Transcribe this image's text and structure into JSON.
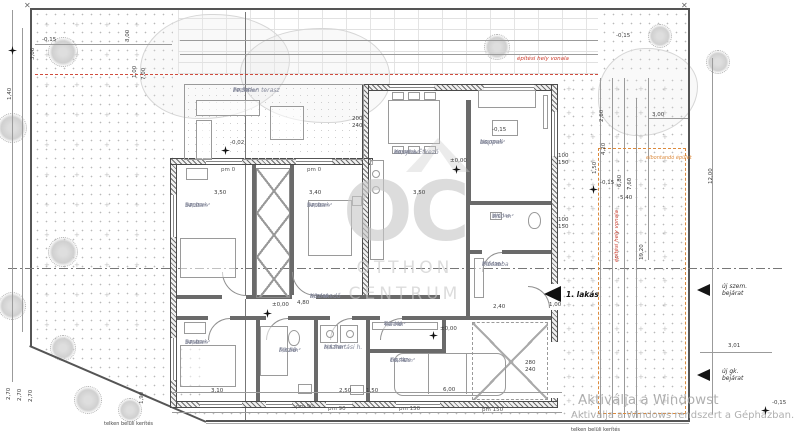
{
  "annotations": {
    "building_line_top": "építési hely vonala",
    "building_line_side": "építési hely vonala",
    "demolish": "elbontandó épület",
    "fence_left": "telken belüli kerítés",
    "fence_right": "telken belüli kerítés",
    "flat_entrance": "1. lakás",
    "entrance_ped_1": "új szem.",
    "entrance_ped_2": "bejárat",
    "entrance_veh_1": "új gk.",
    "entrance_veh_2": "bejárat"
  },
  "watermark": {
    "letters": "OC",
    "line1": "OTTHON",
    "line2": "CENTRUM"
  },
  "windows_activation": {
    "line1": "Aktiválja a Windowst",
    "line2": "Aktiválja a Windows rendszert a Gépházban."
  },
  "rooms": [
    {
      "name": "Fedetlen terasz",
      "floor": "ker. lap",
      "area": "22,50 m²",
      "x": 233,
      "y": 88,
      "w": 92
    },
    {
      "name": "Szoba",
      "floor": "lam.park.",
      "area": "14,35 m²",
      "x": 185,
      "y": 203,
      "w": 62
    },
    {
      "name": "Szoba",
      "floor": "lam.park.",
      "area": "14,76 m²",
      "x": 307,
      "y": 203,
      "w": 62
    },
    {
      "name": "Konyha-Étkező",
      "floor": "lam.park.",
      "area": "29,06 m²",
      "x": 394,
      "y": 150,
      "w": 64
    },
    {
      "name": "Nappali",
      "floor": "lam.park.",
      "area": "16,02 m²",
      "x": 480,
      "y": 140,
      "w": 60
    },
    {
      "name": "WC",
      "floor": "ker. lap",
      "area": "3,90 m²",
      "x": 492,
      "y": 214,
      "w": 46
    },
    {
      "name": "Előszoba",
      "floor": "ker. lap",
      "area": "7,26 m²",
      "x": 482,
      "y": 262,
      "w": 58
    },
    {
      "name": "Közlekedő",
      "floor": "ker. lap",
      "area": "5,76 m²",
      "x": 310,
      "y": 294,
      "w": 56
    },
    {
      "name": "Szoba",
      "floor": "lam.park.",
      "area": "14,46 m²",
      "x": 185,
      "y": 340,
      "w": 62
    },
    {
      "name": "Fürdő",
      "floor": "ker. lap",
      "area": "5,62 m²",
      "x": 279,
      "y": 348,
      "w": 40
    },
    {
      "name": "Háztartási h.",
      "floor": "ker. lap",
      "area": "5,51 m²",
      "x": 324,
      "y": 345,
      "w": 50
    },
    {
      "name": "Tároló",
      "floor": "ker. lap",
      "area": "4,27 m²",
      "x": 384,
      "y": 322,
      "w": 52
    },
    {
      "name": "Garázs",
      "floor": "ker. lap",
      "area": "16,74 m²",
      "x": 390,
      "y": 358,
      "w": 52
    }
  ],
  "dims": [
    {
      "t": "3,06",
      "x": 31,
      "y": 60,
      "v": 1
    },
    {
      "t": "3,00",
      "x": 126,
      "y": 42,
      "v": 1
    },
    {
      "t": "1,00",
      "x": 133,
      "y": 78,
      "v": 1
    },
    {
      "t": "7,00",
      "x": 142,
      "y": 80,
      "v": 1
    },
    {
      "t": "1,40",
      "x": 8,
      "y": 100,
      "v": 1
    },
    {
      "t": "-0,15",
      "x": 42,
      "y": 38,
      "v": 0
    },
    {
      "t": "-0,15",
      "x": 616,
      "y": 34,
      "v": 0
    },
    {
      "t": "-0,02",
      "x": 230,
      "y": 141,
      "v": 0
    },
    {
      "t": "±0,00",
      "x": 450,
      "y": 159,
      "v": 0
    },
    {
      "t": "±0,00",
      "x": 272,
      "y": 303,
      "v": 0
    },
    {
      "t": "±0,00",
      "x": 440,
      "y": 327,
      "v": 0
    },
    {
      "t": "-0,15",
      "x": 600,
      "y": 181,
      "v": 0
    },
    {
      "t": "-0,15",
      "x": 492,
      "y": 128,
      "v": 0
    },
    {
      "t": "-0,15",
      "x": 772,
      "y": 401,
      "v": 0
    },
    {
      "t": "2,60",
      "x": 600,
      "y": 122,
      "v": 1
    },
    {
      "t": "4,20",
      "x": 602,
      "y": 155,
      "v": 1
    },
    {
      "t": "1,50",
      "x": 593,
      "y": 174,
      "v": 1
    },
    {
      "t": "6,80",
      "x": 618,
      "y": 187,
      "v": 1
    },
    {
      "t": "7,60",
      "x": 628,
      "y": 190,
      "v": 1
    },
    {
      "t": "5,40",
      "x": 620,
      "y": 196,
      "v": 0
    },
    {
      "t": "3,00",
      "x": 652,
      "y": 113,
      "v": 0
    },
    {
      "t": "19,20",
      "x": 640,
      "y": 260,
      "v": 1
    },
    {
      "t": "12,00",
      "x": 709,
      "y": 184,
      "v": 1
    },
    {
      "t": "3,01",
      "x": 728,
      "y": 344,
      "v": 0
    },
    {
      "t": "3,50",
      "x": 214,
      "y": 191,
      "v": 0
    },
    {
      "t": "3,40",
      "x": 309,
      "y": 191,
      "v": 0
    },
    {
      "t": "3,50",
      "x": 413,
      "y": 191,
      "v": 0
    },
    {
      "t": "3,10",
      "x": 211,
      "y": 389,
      "v": 0
    },
    {
      "t": "2,50",
      "x": 339,
      "y": 389,
      "v": 0
    },
    {
      "t": "1,50",
      "x": 366,
      "y": 389,
      "v": 0
    },
    {
      "t": "6,00",
      "x": 443,
      "y": 388,
      "v": 0
    },
    {
      "t": "4,80",
      "x": 297,
      "y": 301,
      "v": 0
    },
    {
      "t": "2,40",
      "x": 493,
      "y": 305,
      "v": 0
    },
    {
      "t": "1,00",
      "x": 549,
      "y": 303,
      "v": 0
    },
    {
      "t": "2,70",
      "x": 7,
      "y": 400,
      "v": 1
    },
    {
      "t": "2,70",
      "x": 18,
      "y": 401,
      "v": 1
    },
    {
      "t": "2,70",
      "x": 29,
      "y": 402,
      "v": 1
    },
    {
      "t": "1,90",
      "x": 140,
      "y": 404,
      "v": 1
    },
    {
      "t": "200",
      "x": 352,
      "y": 117,
      "v": 0
    },
    {
      "t": "240",
      "x": 352,
      "y": 124,
      "v": 0
    },
    {
      "t": "100",
      "x": 558,
      "y": 154,
      "v": 0
    },
    {
      "t": "150",
      "x": 558,
      "y": 161,
      "v": 0
    },
    {
      "t": "100",
      "x": 558,
      "y": 218,
      "v": 0
    },
    {
      "t": "150",
      "x": 558,
      "y": 225,
      "v": 0
    },
    {
      "t": "280",
      "x": 525,
      "y": 361,
      "v": 0
    },
    {
      "t": "240",
      "x": 525,
      "y": 368,
      "v": 0
    },
    {
      "t": "pm 0",
      "x": 221,
      "y": 168,
      "v": 0
    },
    {
      "t": "pm 0",
      "x": 307,
      "y": 168,
      "v": 0
    },
    {
      "t": "pm 90",
      "x": 296,
      "y": 405,
      "v": 0
    },
    {
      "t": "pm 90",
      "x": 328,
      "y": 407,
      "v": 0
    },
    {
      "t": "pm 150",
      "x": 399,
      "y": 407,
      "v": 0
    },
    {
      "t": "pm 150",
      "x": 482,
      "y": 408,
      "v": 0
    }
  ],
  "stars": [
    {
      "x": 8,
      "y": 46
    },
    {
      "x": 221,
      "y": 146
    },
    {
      "x": 452,
      "y": 165
    },
    {
      "x": 263,
      "y": 309
    },
    {
      "x": 429,
      "y": 331
    },
    {
      "x": 589,
      "y": 185
    },
    {
      "x": 761,
      "y": 406
    }
  ],
  "trees": [
    {
      "x": 48,
      "y": 37,
      "r": 15
    },
    {
      "x": -3,
      "y": 113,
      "r": 15
    },
    {
      "x": 48,
      "y": 237,
      "r": 15
    },
    {
      "x": -2,
      "y": 292,
      "r": 14
    },
    {
      "x": 50,
      "y": 335,
      "r": 13
    },
    {
      "x": 74,
      "y": 386,
      "r": 14
    },
    {
      "x": 118,
      "y": 398,
      "r": 12
    },
    {
      "x": 484,
      "y": 34,
      "r": 13
    },
    {
      "x": 648,
      "y": 24,
      "r": 12
    },
    {
      "x": 706,
      "y": 50,
      "r": 12
    }
  ],
  "blobs": [
    {
      "x": 140,
      "y": 14,
      "w": 150,
      "h": 105,
      "k": "b1"
    },
    {
      "x": 240,
      "y": 28,
      "w": 150,
      "h": 95,
      "k": "b2"
    },
    {
      "x": 598,
      "y": 48,
      "w": 100,
      "h": 88,
      "k": "b1"
    }
  ],
  "glyphs": {
    "cross": "+",
    "corner": "✕"
  }
}
